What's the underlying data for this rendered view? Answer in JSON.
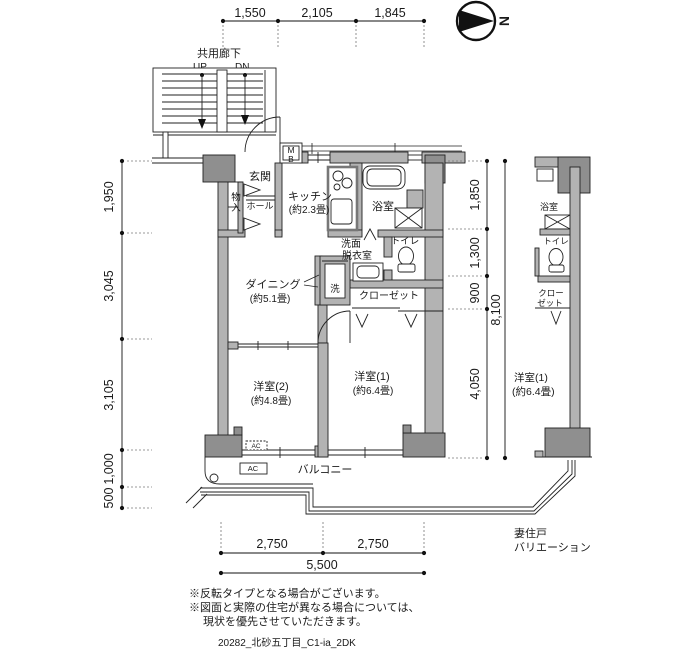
{
  "compass": {
    "north_label": "N"
  },
  "corridor": {
    "label": "共用廊下",
    "up_label": "UP",
    "down_label": "DN"
  },
  "dimensions": {
    "top": [
      "1,550",
      "2,105",
      "1,845"
    ],
    "left": [
      "1,950",
      "3,045",
      "3,105",
      "1,000",
      "500"
    ],
    "right_segments": [
      "1,850",
      "1,300",
      "900",
      "4,050"
    ],
    "right_total": "8,100",
    "bottom_segments": [
      "2,750",
      "2,750"
    ],
    "bottom_total": "5,500"
  },
  "main_plan": {
    "entrance": "玄関",
    "hall": "ホール",
    "storage": "物入",
    "meter_box_line1": "M",
    "meter_box_line2": "B",
    "kitchen_line1": "キッチン",
    "kitchen_line2": "(約2.3畳)",
    "bath": "浴室",
    "washroom_line1": "洗面",
    "washroom_line2": "脱衣室",
    "toilet": "トイレ",
    "washer": "洗",
    "closet": "クローゼット",
    "dining_line1": "ダイニング",
    "dining_line2": "(約5.1畳)",
    "bedroom2_line1": "洋室(2)",
    "bedroom2_line2": "(約4.8畳)",
    "bedroom1_line1": "洋室(1)",
    "bedroom1_line2": "(約6.4畳)",
    "balcony": "バルコニー",
    "ac_unit": "AC",
    "ac_outdoor": "AC"
  },
  "variation_plan": {
    "bath": "浴室",
    "toilet": "トイレ",
    "closet_line1": "クロー",
    "closet_line2": "ゼット",
    "bedroom1_line1": "洋室(1)",
    "bedroom1_line2": "(約6.4畳)",
    "caption_line1": "妻住戸",
    "caption_line2": "バリエーション"
  },
  "notes": {
    "line1": "※反転タイプとなる場合がございます。",
    "line2": "※図面と実際の住宅が異なる場合については、",
    "line3": "現状を優先させていただきます。"
  },
  "plan_id": "20282_北砂五丁目_C1-ia_2DK"
}
